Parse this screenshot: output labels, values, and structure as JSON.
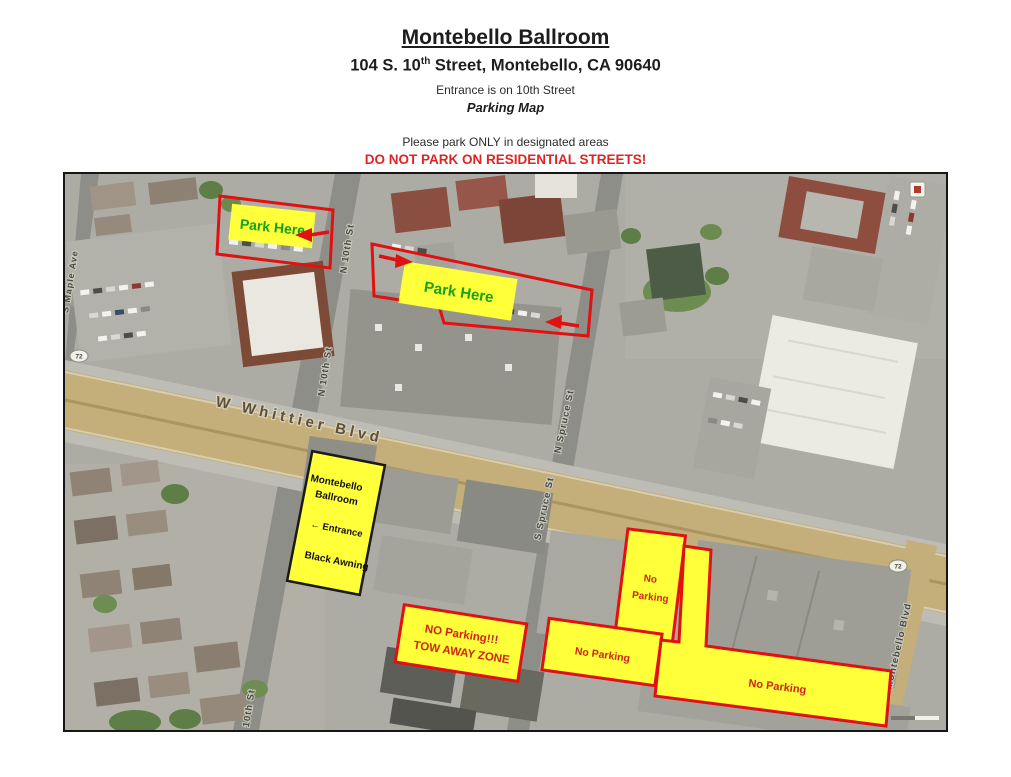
{
  "header": {
    "title": "Montebello Ballroom",
    "address_pre": "104 S. 10",
    "address_sup": "th",
    "address_post": " Street, Montebello, CA 90640",
    "entrance_note": "Entrance is on 10th Street",
    "subtitle": "Parking Map",
    "instruction": "Please park ONLY in designated areas",
    "warning": "DO NOT PARK ON RESIDENTIAL STREETS!"
  },
  "map": {
    "streets": {
      "whittier": "W Whittier Blvd",
      "n_10th": "N 10th St",
      "n_10th_b": "N 10th St",
      "s_10th": "S 10th St",
      "n_spruce": "N Spruce St",
      "s_spruce": "S Spruce St",
      "montebello": "S Montebello Blvd",
      "maple": "S Maple Ave",
      "route_shield": "72"
    },
    "annotations": {
      "park_here_1": "Park Here",
      "park_here_2": "Park Here",
      "ballroom": {
        "line1": "Montebello",
        "line2": "Ballroom",
        "line3": "← Entrance",
        "line4": "Black Awning"
      },
      "tow": {
        "line1": "NO Parking!!!",
        "line2": "TOW AWAY ZONE"
      },
      "np_vertical": {
        "line1": "No",
        "line2": "Parking"
      },
      "np_left": "No Parking",
      "np_right": "No Parking"
    },
    "colors": {
      "highlight_yellow": "#ffff3a",
      "outline_red": "#e01111",
      "park_here_green": "#17a017",
      "no_parking_red": "#cf2512",
      "warning_red": "#e02424"
    }
  }
}
